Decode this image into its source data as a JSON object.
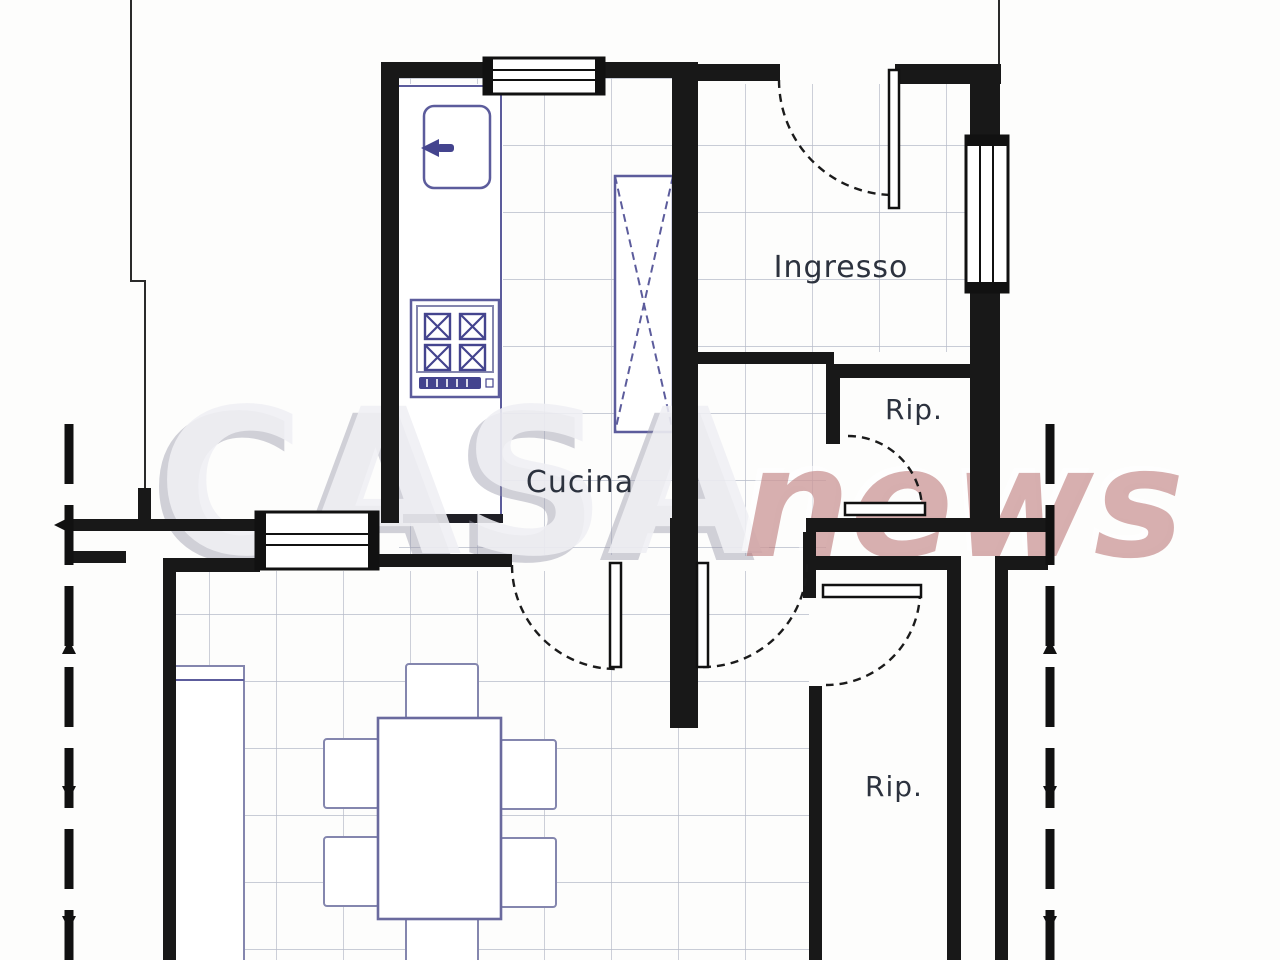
{
  "plan": {
    "rooms": {
      "kitchen": {
        "label": "Cucina"
      },
      "entrance": {
        "label": "Ingresso"
      },
      "storage_small": {
        "label": "Rip."
      },
      "storage_large": {
        "label": "Rip."
      }
    },
    "watermark": {
      "brand_gray": "CASA",
      "brand_red": "news"
    },
    "colors": {
      "wall": "#181818",
      "furniture_outline": "#5c5c9c",
      "tile_line": "#b7bbc9",
      "label_text": "#2c323e",
      "watermark_gray": "#efeff4",
      "watermark_red": "#b76e6e"
    }
  }
}
